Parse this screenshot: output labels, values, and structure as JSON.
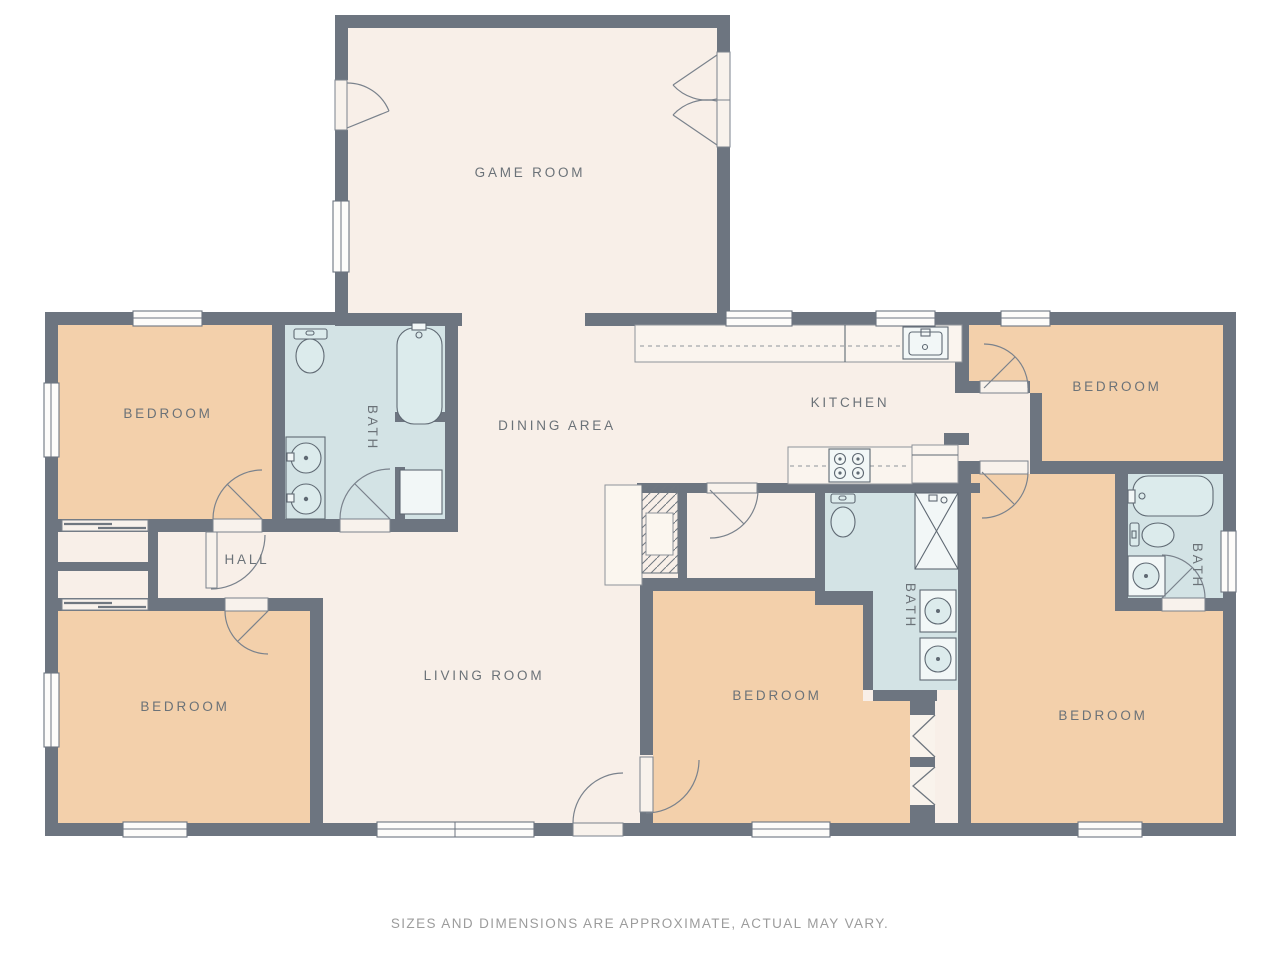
{
  "floor_plan": {
    "rooms": {
      "game_room": "GAME ROOM",
      "bedroom_top_left": "BEDROOM",
      "bath_top_left": "BATH",
      "dining_area": "DINING AREA",
      "kitchen": "KITCHEN",
      "bedroom_top_right": "BEDROOM",
      "hall": "HALL",
      "bath_right": "BATH",
      "bedroom_bottom_left": "BEDROOM",
      "living_room": "LIVING ROOM",
      "bedroom_bottom_middle": "BEDROOM",
      "bath_middle": "BATH",
      "bedroom_bottom_right": "BEDROOM"
    },
    "disclaimer": "SIZES AND DIMENSIONS ARE APPROXIMATE, ACTUAL MAY VARY.",
    "colors": {
      "wall": "#6d7580",
      "floor_main": "#f8efe8",
      "floor_bedroom": "#f3d0ab",
      "floor_bath": "#d3e3e5",
      "counter_fill": "#faf4ee",
      "fixture_stroke": "#5f6973",
      "label_text": "#6b7278",
      "disclaimer_text": "#9c9c9c"
    }
  }
}
